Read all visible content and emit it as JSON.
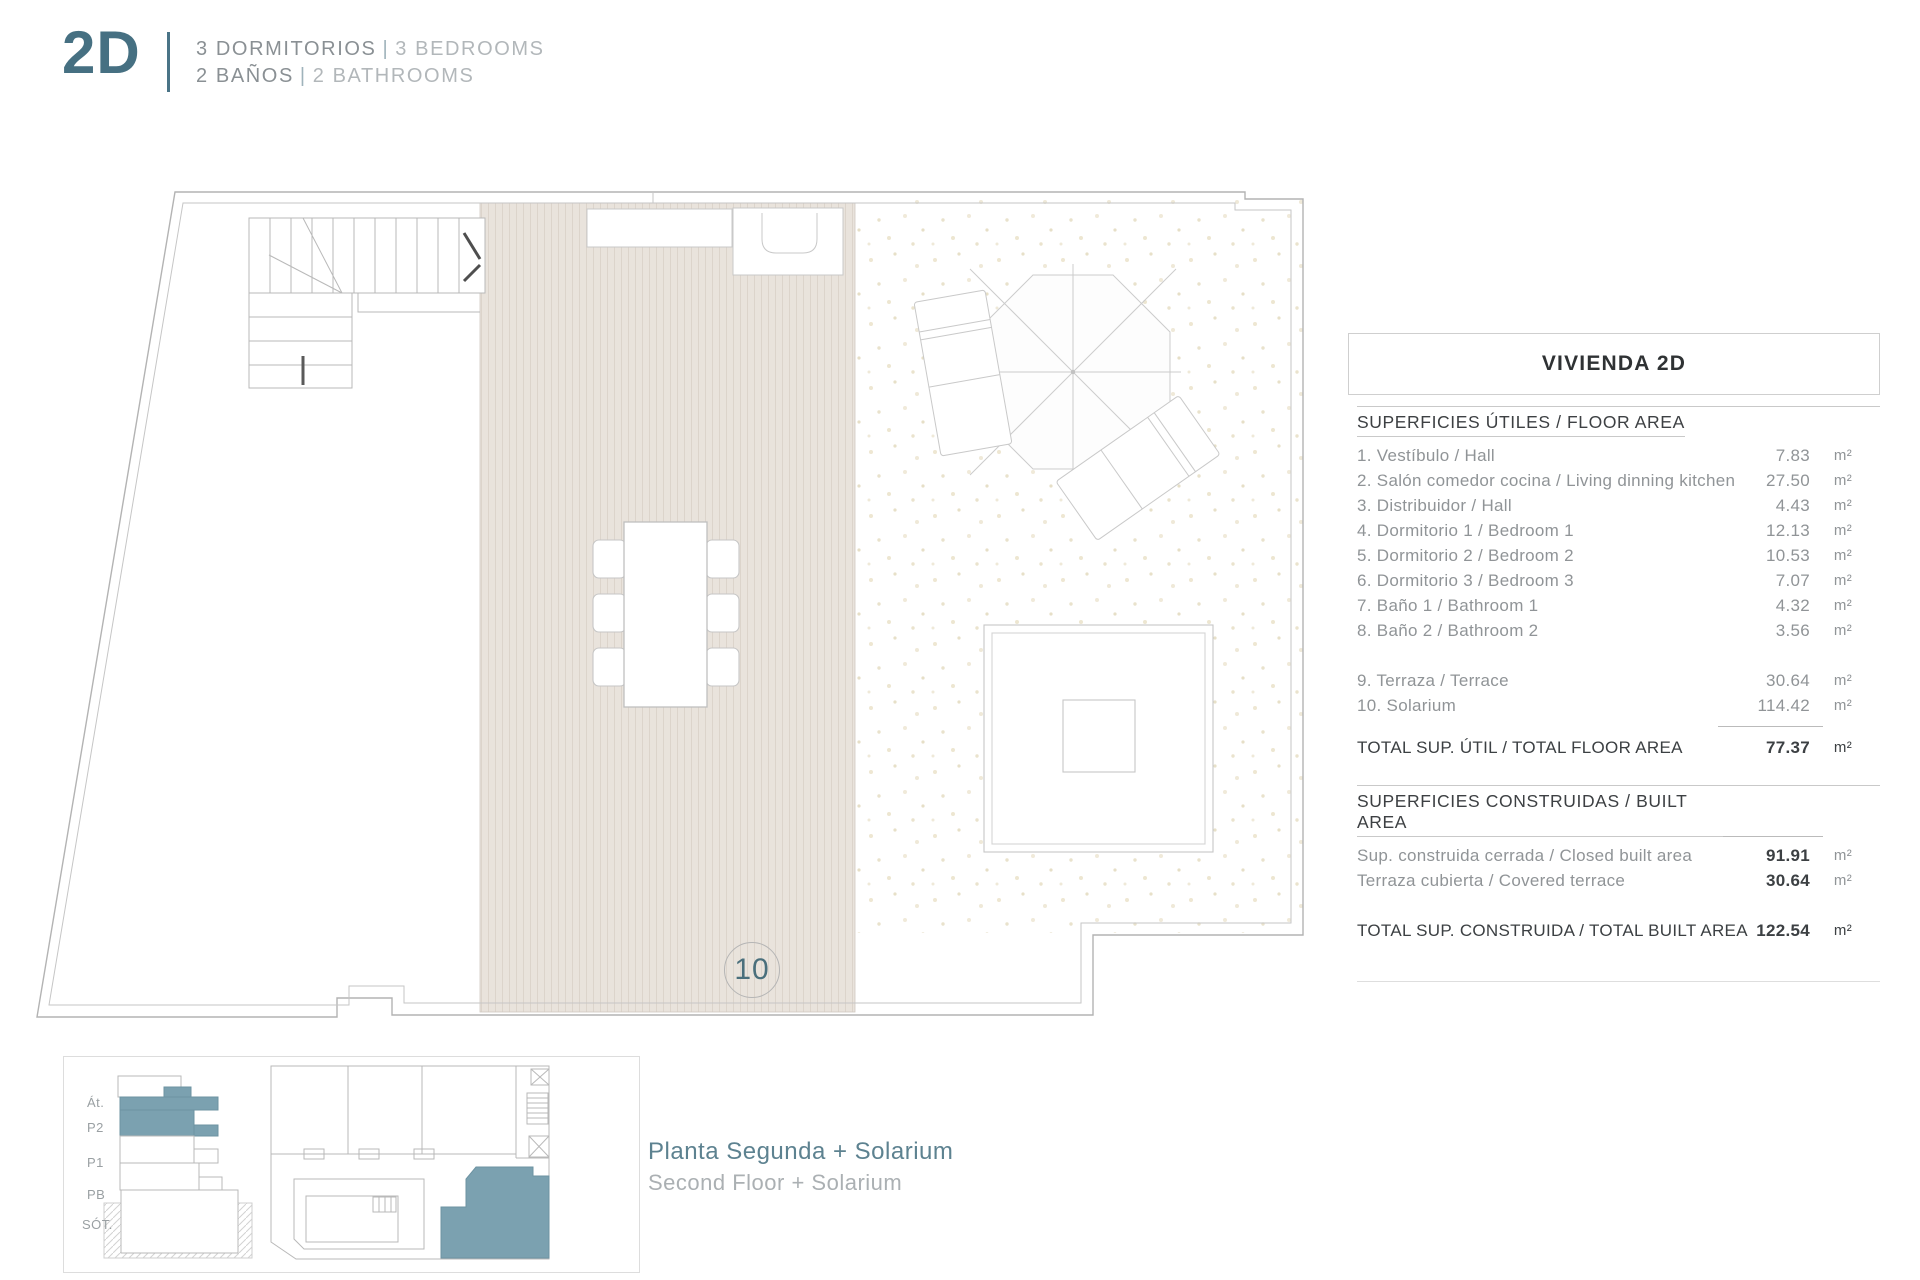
{
  "header": {
    "unit_code": "2D",
    "line1": {
      "es": "3 DORMITORIOS",
      "sep": "|",
      "en": "3 BEDROOMS"
    },
    "line2": {
      "es": "2 BAÑOS",
      "sep": "|",
      "en": "2 BATHROOMS"
    }
  },
  "plan": {
    "room_number_label": "10"
  },
  "area_table": {
    "title": "VIVIENDA 2D",
    "floor_area": {
      "heading": "SUPERFICIES ÚTILES / FLOOR AREA",
      "rows": [
        {
          "label": "1. Vestíbulo / Hall",
          "value": "7.83",
          "unit": "m²"
        },
        {
          "label": "2. Salón comedor cocina / Living dinning kitchen",
          "value": "27.50",
          "unit": "m²"
        },
        {
          "label": "3. Distribuidor / Hall",
          "value": "4.43",
          "unit": "m²"
        },
        {
          "label": "4. Dormitorio 1 / Bedroom 1",
          "value": "12.13",
          "unit": "m²"
        },
        {
          "label": "5. Dormitorio 2 / Bedroom 2",
          "value": "10.53",
          "unit": "m²"
        },
        {
          "label": "6. Dormitorio 3 / Bedroom 3",
          "value": "7.07",
          "unit": "m²"
        },
        {
          "label": "7. Baño 1 / Bathroom 1",
          "value": "4.32",
          "unit": "m²"
        },
        {
          "label": "8. Baño 2 / Bathroom 2",
          "value": "3.56",
          "unit": "m²"
        }
      ],
      "outdoor_rows": [
        {
          "label": "9. Terraza / Terrace",
          "value": "30.64",
          "unit": "m²"
        },
        {
          "label": "10. Solarium",
          "value": "114.42",
          "unit": "m²"
        }
      ],
      "total": {
        "label": "TOTAL SUP. ÚTIL / TOTAL FLOOR AREA",
        "value": "77.37",
        "unit": "m²"
      }
    },
    "built_area": {
      "heading": "SUPERFICIES CONSTRUIDAS / BUILT AREA",
      "rows": [
        {
          "label": "Sup. construida cerrada / Closed built area",
          "value": "91.91",
          "unit": "m²"
        },
        {
          "label": "Terraza cubierta / Covered terrace",
          "value": "30.64",
          "unit": "m²"
        }
      ],
      "total": {
        "label": "TOTAL SUP. CONSTRUIDA /  TOTAL BUILT AREA",
        "value": "122.54",
        "unit": "m²"
      }
    }
  },
  "key_panel": {
    "floor_labels": [
      "Át.",
      "P2",
      "P1",
      "PB",
      "SÓT."
    ]
  },
  "caption": {
    "es": "Planta Segunda + Solarium",
    "en": "Second Floor + Solarium"
  },
  "colors": {
    "accent_text": "#467082",
    "accent_fill": "#7ba1b0",
    "caption_teal": "#5d8290",
    "wall_gray": "#b3b3b3",
    "deck_fill": "#e9e3dc",
    "label_gray": "#909497",
    "dark_text": "#3c4043"
  }
}
